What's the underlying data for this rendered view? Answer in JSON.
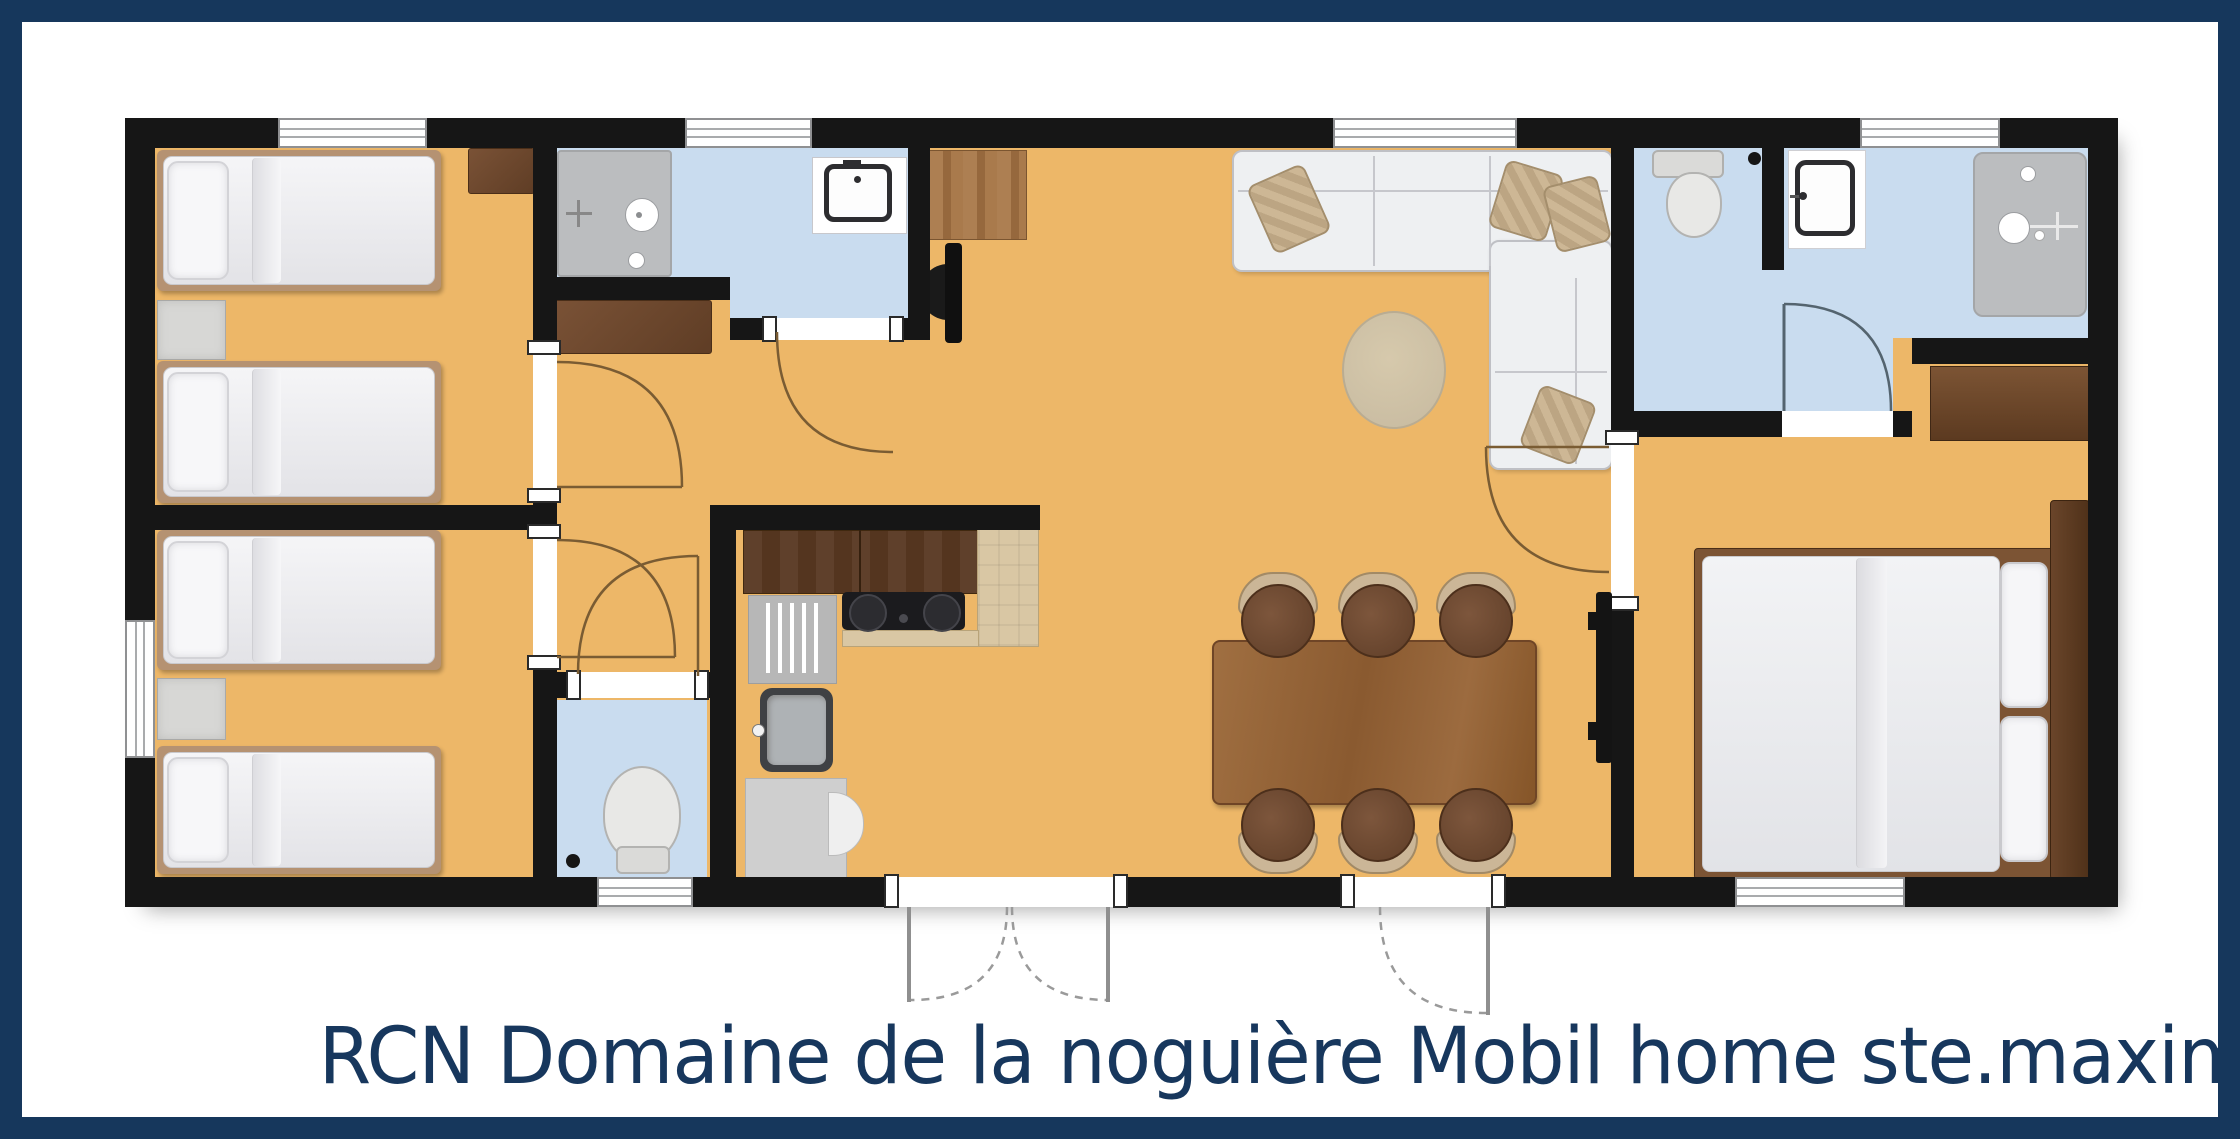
{
  "caption": "RCN Domaine de la noguière Mobil home ste.maxime",
  "palette": {
    "frame_navy": "#16375c",
    "caption_navy": "#17375d",
    "wall_black": "#161616",
    "floor_orange": "#edb768",
    "wet_room_blue": "#c9dcef",
    "shower_gray": "#bbbdbf",
    "wood_dark": "#6f4a33",
    "wood_table": "#9c6b3f",
    "counter_beige": "#d9c7a4",
    "upholstery_white": "#eef0f2"
  },
  "plan": {
    "type": "mobil-home floor plan, top view",
    "rooms": [
      {
        "name": "bedroom-twin-1",
        "furniture": [
          "twin-bed",
          "twin-bed",
          "nightstand",
          "dresser"
        ],
        "windows": [
          "top-wall"
        ]
      },
      {
        "name": "bedroom-twin-2",
        "furniture": [
          "twin-bed",
          "twin-bed",
          "nightstand"
        ],
        "windows": [
          "left-wall"
        ]
      },
      {
        "name": "shower-room",
        "furniture": [
          "shower-tray",
          "washbasin"
        ],
        "windows": [
          "top-wall"
        ]
      },
      {
        "name": "wc",
        "furniture": [
          "toilet"
        ],
        "windows": [
          "bottom-wall"
        ]
      },
      {
        "name": "hallway",
        "furniture": [
          "sideboard"
        ]
      },
      {
        "name": "kitchen",
        "furniture": [
          "wall-cabinets",
          "cooktop-2-burners",
          "drainer",
          "sink",
          "counter"
        ]
      },
      {
        "name": "living-dining",
        "furniture": [
          "corner-sofa",
          "cushions",
          "round-rug",
          "dining-table",
          "6-chairs",
          "tv",
          "entry-mat"
        ],
        "windows": [
          "top-wall"
        ],
        "doors": [
          "french-doors",
          "entrance-door"
        ]
      },
      {
        "name": "bathroom",
        "furniture": [
          "toilet",
          "washbasin",
          "shower"
        ],
        "windows": [
          "top-wall"
        ]
      },
      {
        "name": "master-bedroom",
        "furniture": [
          "double-bed",
          "pillows",
          "headboard",
          "wardrobe"
        ],
        "windows": [
          "bottom-wall"
        ]
      }
    ],
    "door_count": 9,
    "window_count": 7
  }
}
